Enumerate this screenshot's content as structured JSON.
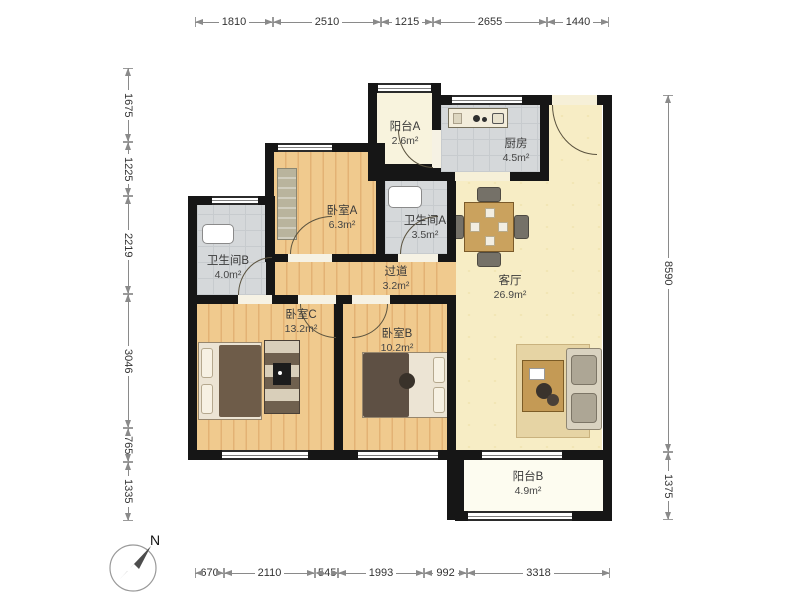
{
  "compass": {
    "label": "N"
  },
  "rooms": {
    "balcony_a": {
      "name": "阳台A",
      "area": "2.6m²"
    },
    "kitchen": {
      "name": "厨房",
      "area": "4.5m²"
    },
    "bath_a": {
      "name": "卫生间A",
      "area": "3.5m²"
    },
    "bed_a": {
      "name": "卧室A",
      "area": "6.3m²"
    },
    "bath_b": {
      "name": "卫生间B",
      "area": "4.0m²"
    },
    "corridor": {
      "name": "过道",
      "area": "3.2m²"
    },
    "living": {
      "name": "客厅",
      "area": "26.9m²"
    },
    "bed_c": {
      "name": "卧室C",
      "area": "13.2m²"
    },
    "bed_b": {
      "name": "卧室B",
      "area": "10.2m²"
    },
    "balcony_b": {
      "name": "阳台B",
      "area": "4.9m²"
    }
  },
  "dimensions": {
    "top": [
      "1810",
      "2510",
      "1215",
      "2655",
      "1440"
    ],
    "bottom": [
      "670",
      "2110",
      "545",
      "1993",
      "992",
      "3318"
    ],
    "left": [
      "1675",
      "1225",
      "2219",
      "3046",
      "765",
      "1335"
    ],
    "right": [
      "8590",
      "1375"
    ]
  },
  "colors": {
    "wall": "#161616",
    "wood_floor": "#f0c88c",
    "tile_floor": "#d5d8da",
    "living_floor": "#f7edc5",
    "balcony_floor": "#fdfcf0"
  }
}
